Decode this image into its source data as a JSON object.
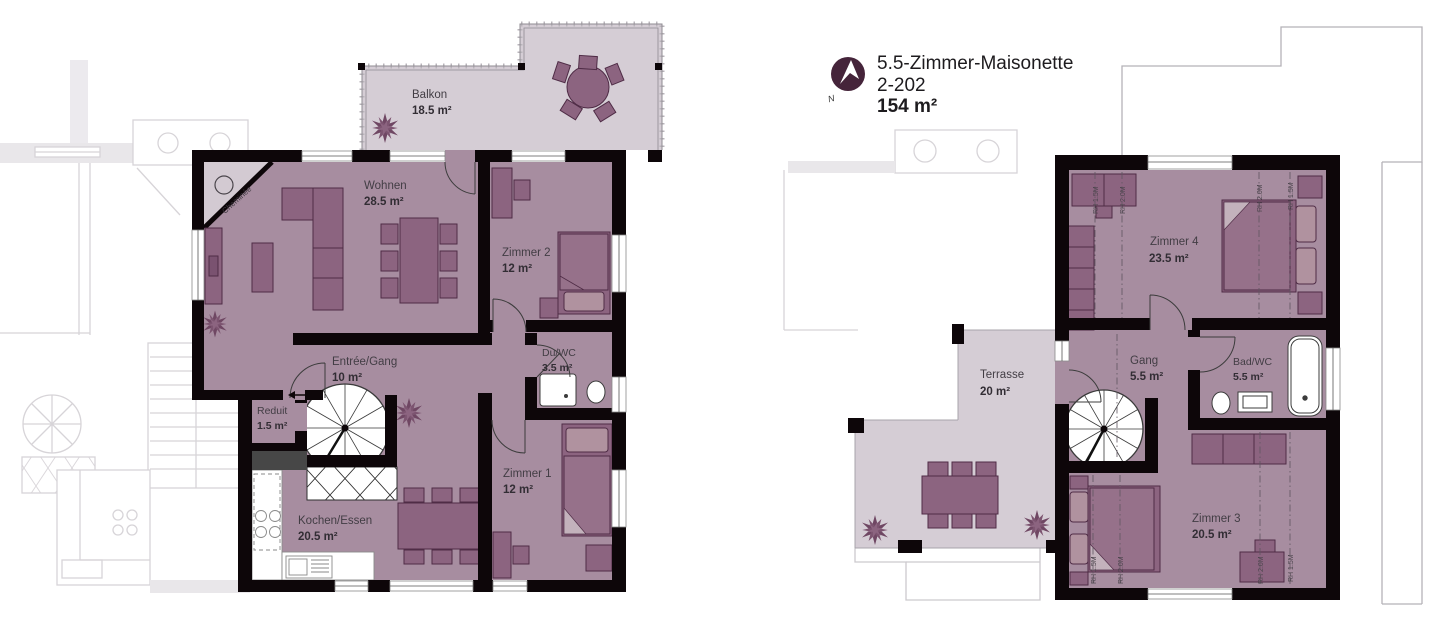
{
  "title": {
    "line1": "5.5-Zimmer-Maisonette",
    "line2": "2-202",
    "line3": "154 m²",
    "compass": "N"
  },
  "floor1": {
    "balkon": {
      "name": "Balkon",
      "area": "18.5 m²"
    },
    "wohnen": {
      "name": "Wohnen",
      "area": "28.5 m²"
    },
    "zimmer2": {
      "name": "Zimmer 2",
      "area": "12 m²"
    },
    "entree": {
      "name": "Entrée/Gang",
      "area": "10 m²"
    },
    "duwc": {
      "name": "Du/WC",
      "area": "3.5 m²"
    },
    "reduit": {
      "name": "Reduit",
      "area": "1.5 m²"
    },
    "zimmer1": {
      "name": "Zimmer 1",
      "area": "12 m²"
    },
    "kochen": {
      "name": "Kochen/Essen",
      "area": "20.5 m²"
    },
    "cheminee": "Cheminée"
  },
  "floor2": {
    "zimmer4": {
      "name": "Zimmer 4",
      "area": "23.5 m²"
    },
    "gang": {
      "name": "Gang",
      "area": "5.5 m²"
    },
    "badwc": {
      "name": "Bad/WC",
      "area": "5.5 m²"
    },
    "zimmer3": {
      "name": "Zimmer 3",
      "area": "20.5 m²"
    },
    "terrasse": {
      "name": "Terrasse",
      "area": "20 m²"
    },
    "rh_15": "RH 1.5M",
    "rh_20": "RH 2.0M"
  },
  "colors": {
    "wall": "#0d0609",
    "room_fill": "#a78da0",
    "outdoor_fill": "#d5cdd5",
    "furniture": "#8c6480",
    "furniture_stroke": "#4f2c46",
    "accent_compass": "#45243a",
    "faint_outline": "#d7d4d8"
  }
}
